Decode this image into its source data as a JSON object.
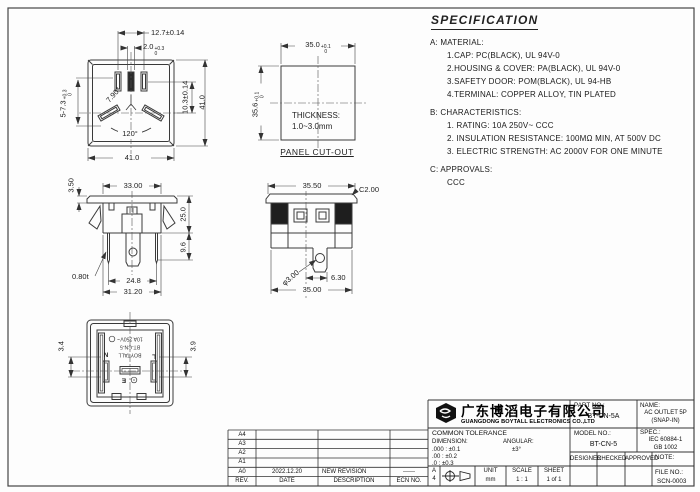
{
  "sheet": {
    "bg": "#fdfdfd",
    "line_color": "#3a3a3a"
  },
  "spec": {
    "title": "SPECIFICATION",
    "a_head": "A: MATERIAL:",
    "a1": "1.CAP: PC(BLACK), UL 94V-0",
    "a2": "2.HOUSING & COVER: PA(BLACK), UL 94V-0",
    "a3": "3.SAFETY DOOR: POM(BLACK), UL 94-HB",
    "a4": "4.TERMINAL: COPPER ALLOY, TIN PLATED",
    "b_head": "B: CHARACTERISTICS:",
    "b1": "1. RATING: 10A 250V~ CCC",
    "b2": "2. INSULATION RESISTANCE: 100MΩ MIN, AT 500V DC",
    "b3": "3. ELECTRIC STRENGTH: AC 2000V FOR ONE MINUTE",
    "c_head": "C: APPROVALS:",
    "c1": "CCC"
  },
  "views": {
    "front": {
      "d_pin_pitch": "12.7±0.14",
      "d_slot_w": "2.0",
      "d_slot_w_up": "+0.3",
      "d_slot_w_dn": "0",
      "d_slot_len": "5-7.3",
      "d_slot_len_up": "+0.3",
      "d_slot_len_dn": "0",
      "d_angle_small": "7.90°",
      "d_angle_arc": "120°",
      "d_width": "41.0",
      "d_height": "41.0",
      "d_row_gap": "10.3±0.14"
    },
    "panel_cutout": {
      "title": "PANEL CUT-OUT",
      "d_w": "35.0",
      "d_w_up": "+0.1",
      "d_w_dn": "0",
      "d_h": "35.6",
      "d_h_up": "+0.1",
      "d_h_dn": "0",
      "thickness_label": "THICKNESS:",
      "thickness_value": "1.0~3.0mm"
    },
    "side": {
      "d_flange_t": "3.50",
      "d_top_w": "33.00",
      "d_body_h": "25.0",
      "d_pin_h": "9.6",
      "d_pin_t": "0.80t",
      "d_pin_span": "24.8",
      "d_body_w": "31.20"
    },
    "side2": {
      "d_flange_w": "35.50",
      "d_chamfer": "C2.00",
      "d_hole": "φ3.00",
      "d_hole_off": "6.30",
      "d_body_w": "35.00"
    },
    "back": {
      "d_left": "3.4",
      "d_right": "3.9",
      "t_n": "N",
      "t_l": "L",
      "t_e": "E",
      "mark_line1": "BOYTALL",
      "mark_line2": "BT-CN-5",
      "mark_line3": "10A 250V~"
    }
  },
  "title_block": {
    "company_cn": "广东博滔电子有限公司",
    "company_en": "GUANGDONG BOYTALL ELECTRONICS CO.,LTD",
    "part_no_label": "PART NO.:",
    "part_no": "BT-CN-5A",
    "name_label": "NAME:",
    "name_value": "AC OUTLET 5P",
    "name_value2": "(SNAP-IN)",
    "model_no_label": "MODEL NO.:",
    "model_no": "BT-CN-5",
    "spec_label": "SPEC.:",
    "spec_value1": "IEC 60884-1",
    "spec_value2": "GB 1002",
    "tolerance_title": "COMMON TOLERANCE",
    "dimension_label": "DIMENSION:",
    "angular_label": "ANGULAR:",
    "tol1": ".000 : ±0.1",
    "tol2": ".00 : ±0.2",
    "tol3": ".0 : ±0.3",
    "angular_value": "±3°",
    "designer": "DESIGNER",
    "checked": "CHECKED",
    "approved": "APPROVED",
    "note_label": "NOTE:",
    "file_no_label": "FILE NO.:",
    "file_no": "SCN-0003",
    "size_a": "A",
    "size_4": "4",
    "unit_label": "UNIT",
    "unit": "mm",
    "scale_label": "SCALE",
    "scale": "1 : 1",
    "sheet_label": "SHEET",
    "sheet": "1 of 1"
  },
  "revision_table": {
    "rows": [
      {
        "rev": "A4",
        "date": "",
        "desc": "",
        "ecn": ""
      },
      {
        "rev": "A3",
        "date": "",
        "desc": "",
        "ecn": ""
      },
      {
        "rev": "A2",
        "date": "",
        "desc": "",
        "ecn": ""
      },
      {
        "rev": "A1",
        "date": "",
        "desc": "",
        "ecn": ""
      },
      {
        "rev": "A0",
        "date": "2022.12.20",
        "desc": "NEW REVISION",
        "ecn": "------"
      },
      {
        "rev": "REV.",
        "date": "DATE",
        "desc": "DESCRIPTION",
        "ecn": "ECN NO."
      }
    ]
  }
}
